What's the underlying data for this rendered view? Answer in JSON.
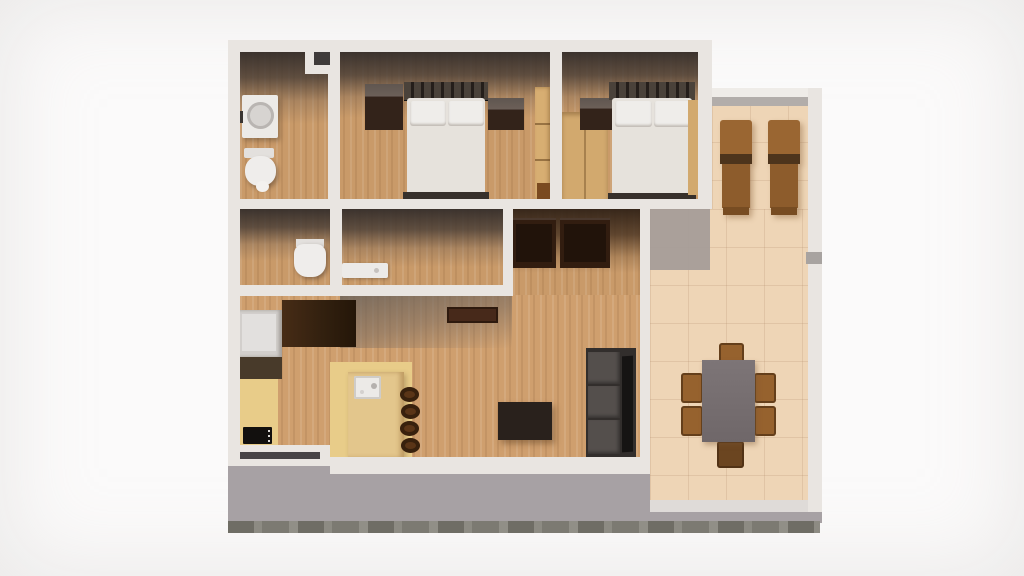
{
  "scene": {
    "type": "3d-floor-plan-render",
    "description": "Top-down 3D render of an apartment floor plan on a white background",
    "rooms": [
      {
        "id": "bathroom-1",
        "position": "top-left",
        "floor": "wood",
        "contents": [
          "washing-machine",
          "toilet"
        ]
      },
      {
        "id": "bedroom-1",
        "position": "top-middle",
        "floor": "wood",
        "contents": [
          "double-bed",
          "nightstand-left",
          "nightstand-right",
          "tall-wardrobe"
        ]
      },
      {
        "id": "bedroom-2",
        "position": "top-right",
        "floor": "wood",
        "contents": [
          "double-bed",
          "nightstand",
          "low-wardrobe",
          "side-wardrobe"
        ]
      },
      {
        "id": "wc",
        "position": "middle-left",
        "floor": "wood",
        "contents": [
          "toilet"
        ]
      },
      {
        "id": "bathroom-2",
        "position": "middle",
        "floor": "wood",
        "contents": [
          "shower-tray"
        ]
      },
      {
        "id": "hallway",
        "position": "middle-right",
        "floor": "wood",
        "contents": [
          "closet-1",
          "closet-2"
        ]
      },
      {
        "id": "living-kitchen",
        "position": "bottom",
        "floor": "wood + yellow kitchen zone",
        "contents": [
          "fridge",
          "kitchen-cabinet",
          "counter",
          "stove",
          "kitchen-island",
          "sink",
          "bar-stools-x4",
          "wall-shelf",
          "tv-stand",
          "sofa",
          "window"
        ]
      },
      {
        "id": "terrace",
        "position": "right-L",
        "floor": "beige tile",
        "contents": [
          "sun-lounger-1",
          "sun-lounger-2",
          "dining-table",
          "dining-chairs-x6"
        ]
      }
    ],
    "furniture_counts": {
      "beds": 2,
      "toilets": 2,
      "sun_loungers": 2,
      "dining_chairs": 6,
      "bar_stools": 4,
      "closets": 2
    },
    "palette": {
      "background": "#fbfafa",
      "wall": "#e9e5e1",
      "wood_floor": "#c99a69",
      "living_wood_floor": "#cf9f6e",
      "kitchen_floor_yellow": "#e8cc89",
      "terrace_tile": "#eed5b6",
      "terrace_shadow": "#a49b98",
      "plinth_gray": "#a7a1a4",
      "ground_strip": "#8d8b83",
      "room_shadow": "#3b3432",
      "bed_mattress": "#e6e2dc",
      "pillow_white": "#efedea",
      "bed_frame_dark": "#241e1a",
      "nightstand_brown": "#33231a",
      "wardrobe_tan": "#d7ae72",
      "closet_dark_brown": "#321d10",
      "lounger_brown": "#9a6632",
      "dining_chair_brown": "#96622e",
      "dining_table_gray": "#787072",
      "sofa_gray": "#544f4c",
      "sofa_side_black": "#161413",
      "tv_stand_black": "#29211c",
      "appliance_white": "#eceae7",
      "fridge_gray": "#d2cfcc",
      "stove_black": "#12100e",
      "window_bar_dark": "#474345"
    }
  }
}
